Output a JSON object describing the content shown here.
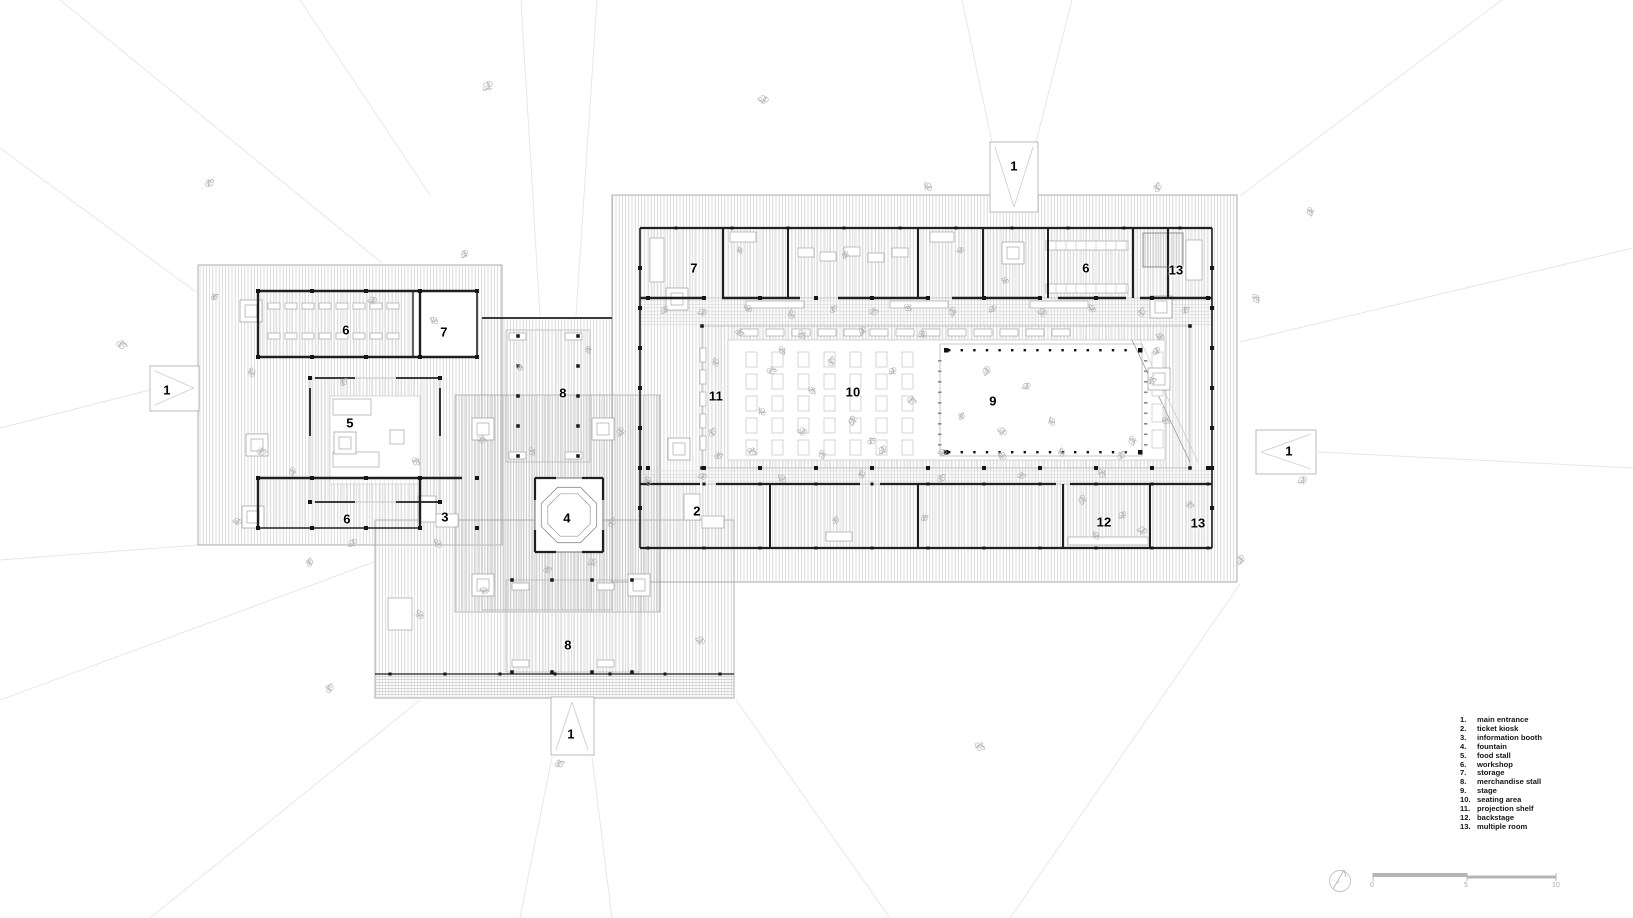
{
  "plan": {
    "room_labels": [
      {
        "id": "left-workshop-top",
        "text": "6",
        "x": 346,
        "y": 330
      },
      {
        "id": "left-storage",
        "text": "7",
        "x": 444,
        "y": 332
      },
      {
        "id": "left-food-stall",
        "text": "5",
        "x": 350,
        "y": 423
      },
      {
        "id": "left-workshop-bottom",
        "text": "6",
        "x": 347,
        "y": 519
      },
      {
        "id": "info-booth",
        "text": "3",
        "x": 445,
        "y": 517
      },
      {
        "id": "merch-stall-top",
        "text": "8",
        "x": 563,
        "y": 393
      },
      {
        "id": "fountain",
        "text": "4",
        "x": 567,
        "y": 518
      },
      {
        "id": "merch-stall-bottom",
        "text": "8",
        "x": 568,
        "y": 645
      },
      {
        "id": "right-storage",
        "text": "7",
        "x": 694,
        "y": 268
      },
      {
        "id": "right-workshop",
        "text": "6",
        "x": 1086,
        "y": 268
      },
      {
        "id": "multiple-room-top",
        "text": "13",
        "x": 1176,
        "y": 270
      },
      {
        "id": "projection-shelf",
        "text": "11",
        "x": 716,
        "y": 396
      },
      {
        "id": "seating-area",
        "text": "10",
        "x": 853,
        "y": 392
      },
      {
        "id": "stage",
        "text": "9",
        "x": 993,
        "y": 401
      },
      {
        "id": "ticket-kiosk",
        "text": "2",
        "x": 697,
        "y": 511
      },
      {
        "id": "backstage",
        "text": "12",
        "x": 1104,
        "y": 522
      },
      {
        "id": "multiple-room-bottom",
        "text": "13",
        "x": 1198,
        "y": 523
      }
    ],
    "entrances": [
      {
        "id": "entrance-top",
        "label": "1",
        "x": 1014,
        "y": 166
      },
      {
        "id": "entrance-left",
        "label": "1",
        "x": 167,
        "y": 390
      },
      {
        "id": "entrance-right",
        "label": "1",
        "x": 1289,
        "y": 451
      },
      {
        "id": "entrance-bottom",
        "label": "1",
        "x": 571,
        "y": 734
      }
    ]
  },
  "legend": {
    "items": [
      {
        "num": "1.",
        "label": "main entrance"
      },
      {
        "num": "2.",
        "label": "ticket kiosk"
      },
      {
        "num": "3.",
        "label": "information booth"
      },
      {
        "num": "4.",
        "label": "fountain"
      },
      {
        "num": "5.",
        "label": "food stall"
      },
      {
        "num": "6.",
        "label": "workshop"
      },
      {
        "num": "7.",
        "label": "storage"
      },
      {
        "num": "8.",
        "label": "merchandise stall"
      },
      {
        "num": "9.",
        "label": "stage"
      },
      {
        "num": "10.",
        "label": "seating area"
      },
      {
        "num": "11.",
        "label": "projection shelf"
      },
      {
        "num": "12.",
        "label": "backstage"
      },
      {
        "num": "13.",
        "label": "multiple room"
      }
    ]
  },
  "scale_bar": {
    "ticks": [
      "0",
      "5",
      "10"
    ]
  },
  "colors": {
    "wall": "#1f1f1f",
    "outline": "#9c9c9c",
    "room_line": "#a8a8a8",
    "sketch": "#b4b4b4",
    "faint": "#e7e7e7",
    "scale_gray": "#b5b5b5",
    "label": "#000000",
    "legend_text": "#141414"
  }
}
